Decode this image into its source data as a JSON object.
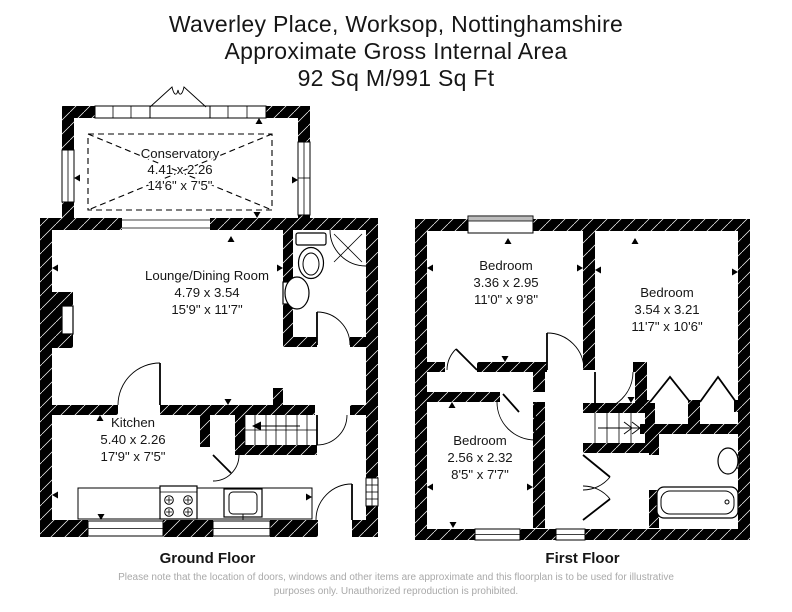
{
  "header": {
    "line1": "Waverley Place, Worksop, Nottinghamshire",
    "line2": "Approximate Gross Internal Area",
    "line3": "92 Sq M/991 Sq Ft"
  },
  "ground_floor": {
    "label": "Ground Floor",
    "rooms": {
      "conservatory": {
        "name": "Conservatory",
        "metric": "4.41 x 2.26",
        "imperial": "14'6\" x 7'5\""
      },
      "lounge": {
        "name": "Lounge/Dining Room",
        "metric": "4.79 x 3.54",
        "imperial": "15'9\" x 11'7\""
      },
      "kitchen": {
        "name": "Kitchen",
        "metric": "5.40 x 2.26",
        "imperial": "17'9\" x 7'5\""
      }
    }
  },
  "first_floor": {
    "label": "First Floor",
    "rooms": {
      "bedroom1": {
        "name": "Bedroom",
        "metric": "3.36 x 2.95",
        "imperial": "11'0\" x 9'8\""
      },
      "bedroom2": {
        "name": "Bedroom",
        "metric": "3.54 x 3.21",
        "imperial": "11'7\" x 10'6\""
      },
      "bedroom3": {
        "name": "Bedroom",
        "metric": "2.56 x 2.32",
        "imperial": "8'5\" x 7'7\""
      }
    }
  },
  "footer": {
    "disclaimer_line1": "Please note that the location of doors, windows and other items are approximate and this floorplan is to be used for illustrative",
    "disclaimer_line2": "purposes only. Unauthorized reproduction is prohibited."
  },
  "colors": {
    "wall": "#000000",
    "text": "#161616",
    "disclaimer": "#a9a9a9",
    "background": "#ffffff"
  }
}
